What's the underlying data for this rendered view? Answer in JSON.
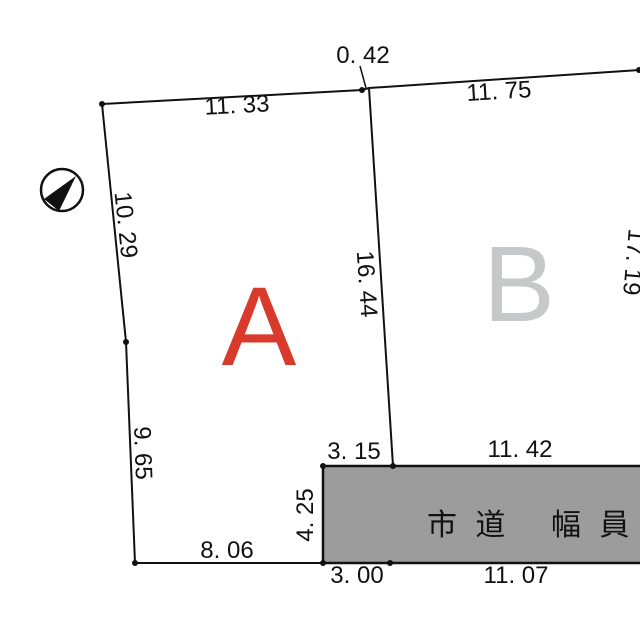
{
  "diagram_type": "land-parcel-survey-plat",
  "parcels": {
    "a": {
      "label": "A",
      "color": "#d83a2b"
    },
    "b": {
      "label": "B",
      "color": "#c7c8ca"
    }
  },
  "dims": {
    "top_offset": "0. 42",
    "top_a": "11. 33",
    "top_b": "11. 75",
    "left_upper": "10. 29",
    "left_lower": "9. 65",
    "center_divider": "16. 44",
    "right_b": "17. 19",
    "road_top_left": "3. 15",
    "road_top_right": "11. 42",
    "road_width": "4. 25",
    "bottom_a": "8. 06",
    "road_bottom_left": "3. 00",
    "road_bottom_right": "11. 07"
  },
  "road": {
    "name_left": "市 道",
    "name_right": "幅 員 約",
    "fill_color": "#9c9c9c"
  },
  "icons": {
    "north_arrow": "compass-north-arrow"
  },
  "colors": {
    "line": "#111111",
    "background": "#ffffff"
  }
}
